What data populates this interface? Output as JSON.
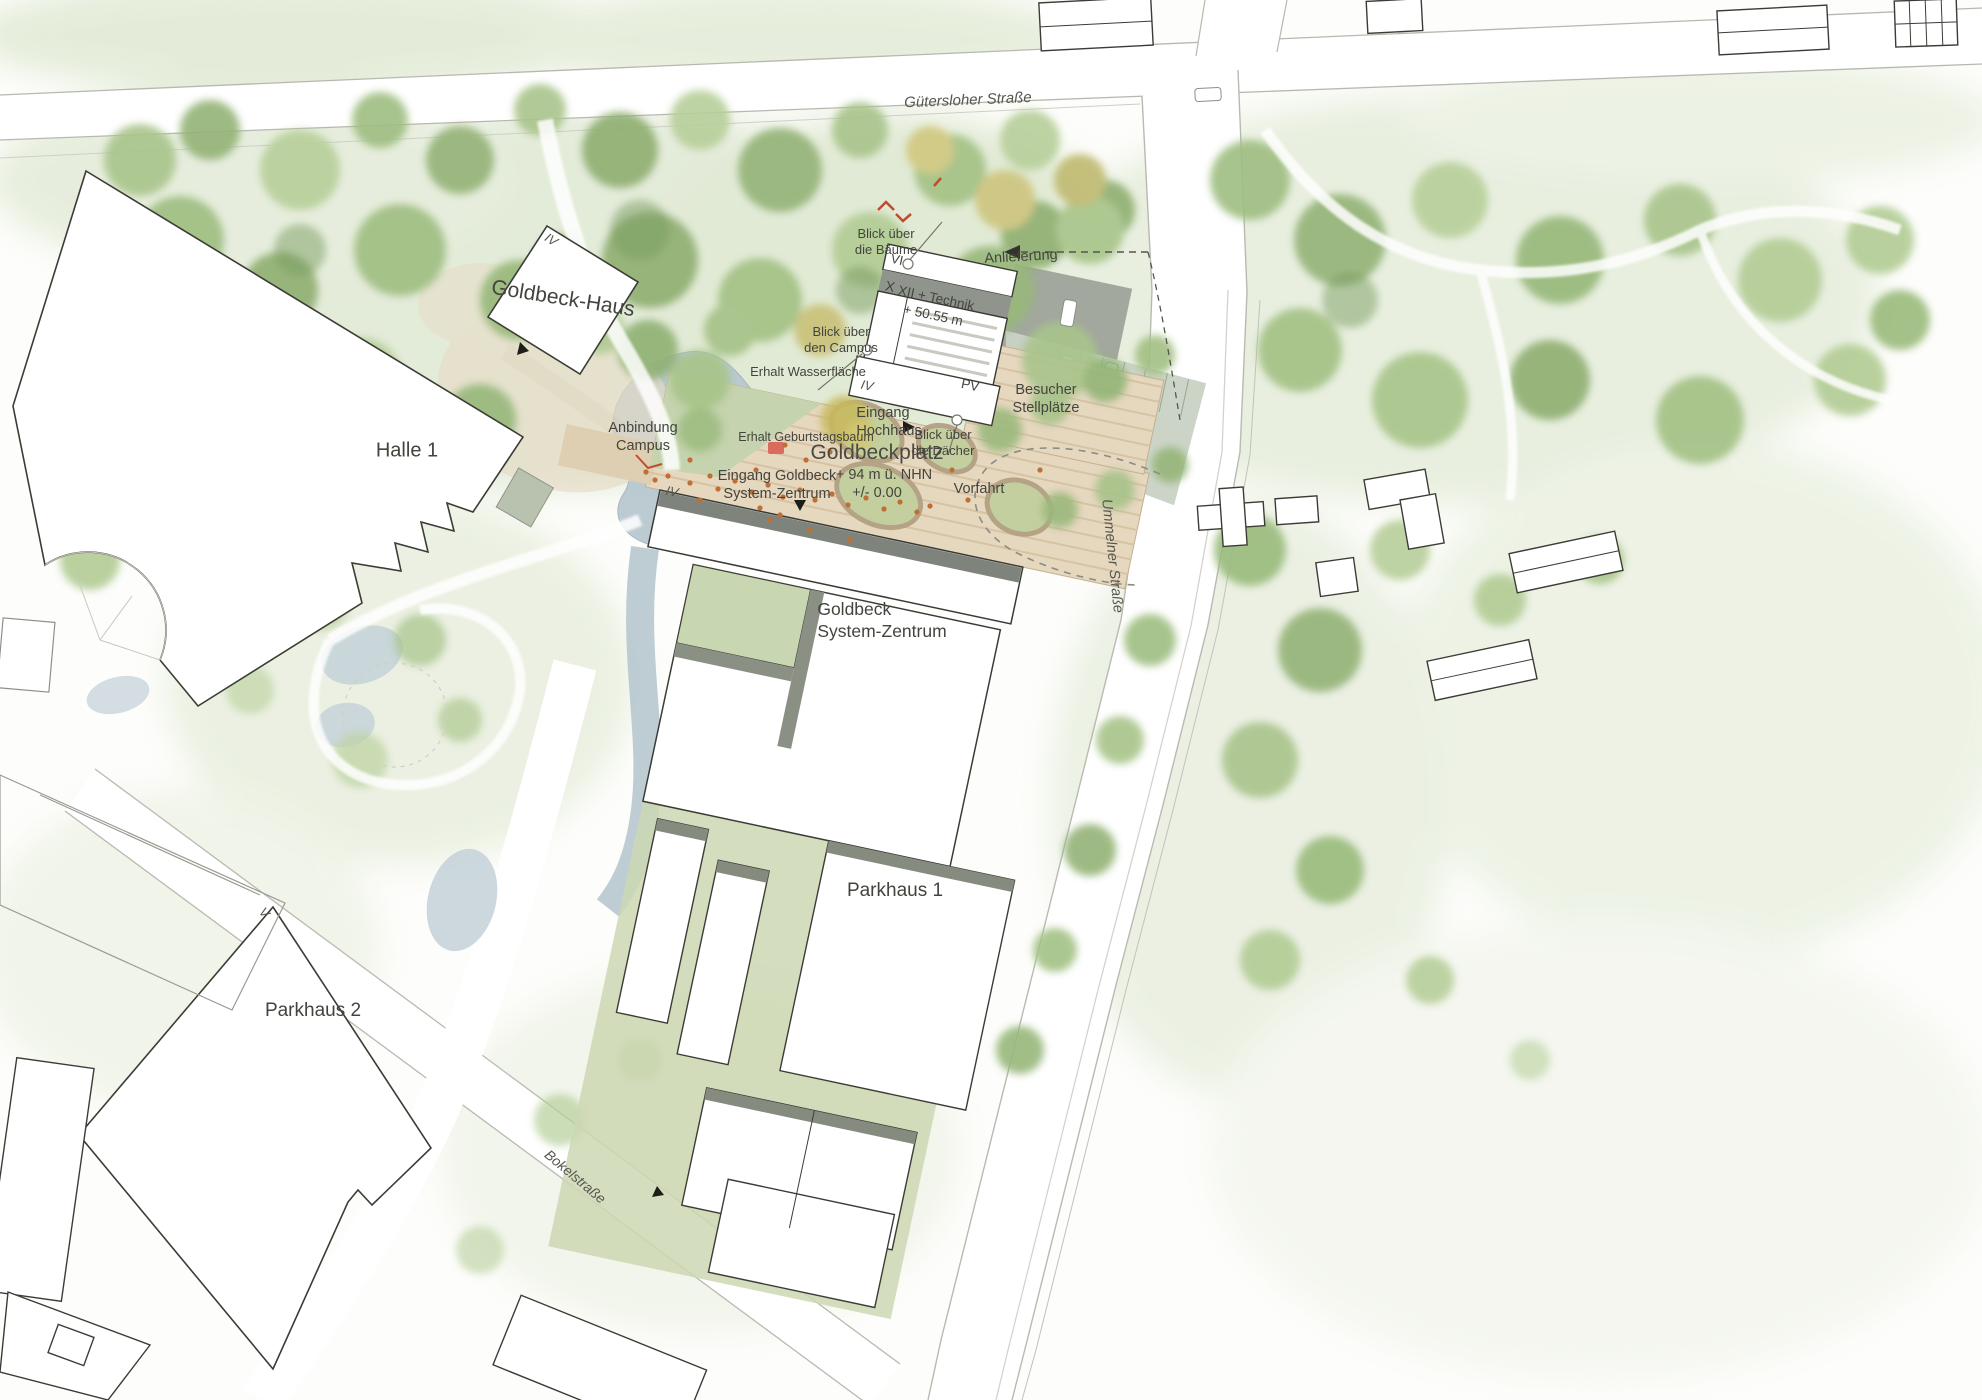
{
  "palette": {
    "canopy_green": "#9dbb7e",
    "water_blue": "#b7c7cf",
    "plaza_beige": "#e6d7bf",
    "shadow_grey": "#8b9085",
    "accent_red": "#c14b2e",
    "people_orange": "#bf6f35"
  },
  "streets": {
    "guetersloher": "Gütersloher Straße",
    "ummelner": "Ummelner Straße",
    "bokel": "Bokelstraße"
  },
  "buildings": {
    "goldbeck_haus": "Goldbeck-Haus",
    "halle_1": "Halle 1",
    "system_zentrum": "Goldbeck\nSystem-Zentrum",
    "parkhaus_1": "Parkhaus 1",
    "parkhaus_2": "Parkhaus 2"
  },
  "plaza": {
    "name": "Goldbeckplatz",
    "elevation": "+ 94 m ü. NHN",
    "level": "+/- 0.00"
  },
  "tower": {
    "roof_upper": "VI",
    "floors_west": "X",
    "roof_label": "XII + Technik",
    "roof_height": "+ 50.55 m",
    "base_floors": "IV",
    "pv": "PV"
  },
  "floor_marks": {
    "goldbeck_haus": "IV",
    "system_zentrum": "IV",
    "parkhaus_2": "V"
  },
  "annotations": {
    "anlieferung": "Anlieferung",
    "besucher": "Besucher\nStellplätze",
    "vorfahrt": "Vorfahrt",
    "eingang_hochhaus": "Eingang\nHochhaus",
    "eingang_system_zentrum": "Eingang Goldbeck\nSystem-Zentrum",
    "anbindung_campus": "Anbindung\nCampus",
    "erhalt_wasserflaeche": "Erhalt Wasserfläche",
    "erhalt_geburtstagsbaum": "Erhalt Geburtstagsbaum",
    "blick_campus": "Blick über\nden Campus",
    "blick_baeume": "Blick über\ndie Bäume",
    "blick_daecher": "Blick über\ndie Dächer"
  }
}
